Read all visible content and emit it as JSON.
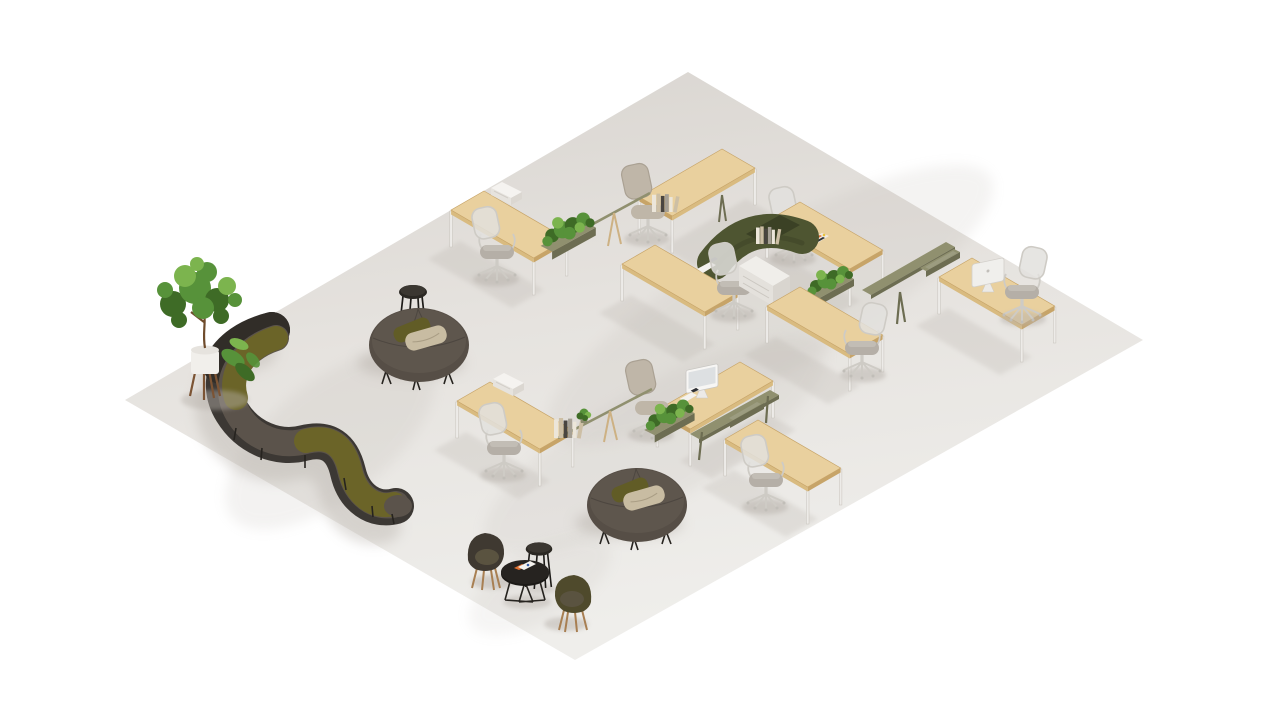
{
  "scene": {
    "description": "Isometric 3D render of an open-plan office: two zig-zag workstation pods with oak desks, task chairs, olive rails, planters and a green felt privacy screen on a light gray floor; a serpentine brown-and-olive modular sofa, two round ottomans with pillows, a potted fig tree, and a cafe corner with tub chairs and small black tables",
    "background": "#ffffff"
  },
  "palette": {
    "floor-top": "#d8d4cf",
    "floor-mid": "#e6e3df",
    "floor-bottom": "#efeeeb",
    "shadow": "#b7b1aa",
    "wood": "#e9d09e",
    "wood-edge": "#c7a468",
    "wood-shade": "#d9bb80",
    "leg": "#edebe8",
    "olive": "#90906f",
    "olive-dark": "#6d6d52",
    "felt-green": "#4e5531",
    "felt-dark": "#3b4125",
    "plant-dark": "#3e6b26",
    "plant-mid": "#57923a",
    "plant-light": "#7cb44e",
    "mesh": "#e2e0dd",
    "chair-frame": "#cecbc5",
    "chair-seat": "#b5afa7",
    "chair-cushion": "#bfb6a8",
    "sofa-back": "#3c3834",
    "sofa-charcoal": "#312d28",
    "sofa-brown": "#5b534b",
    "sofa-olive": "#6b6428",
    "ottoman": "#564e46",
    "ottoman-top": "#5e564d",
    "pillow-olive": "#615c26",
    "pillow-beige": "#c8bca2",
    "cafe-chair-dark": "#3f3931",
    "cafe-chair-olive": "#4f4a2c",
    "cafe-cushion": "#5a5340",
    "stand-brown": "#a87f52",
    "pot-white": "#f1efeb",
    "pot-stand": "#7c5434",
    "trunk": "#6f4c2c",
    "white": "#f7f6f4",
    "screen-gray": "#dde0e2",
    "paper": "#f4f2ee",
    "poster-orange": "#df7030",
    "poster-blue": "#3a5fa8",
    "book-cream": "#ece6da",
    "book-tan": "#cdbfa5",
    "book-dark": "#494540",
    "book-gray": "#a59f94"
  },
  "inventory": {
    "workstation_desks": 9,
    "task_chairs": 9,
    "desktop_monitors": 2,
    "white_desk_devices": 3,
    "desk_planters": 3,
    "small_desk_plants": 1,
    "book_sets": 3,
    "felt_privacy_screens": 1,
    "storage_pedestals": 1,
    "rail_trays": 2,
    "serpentine_sofa_segments": 6,
    "round_ottomans": 2,
    "ottoman_pillows": 4,
    "potted_trees": 1,
    "cafe_tub_chairs": 2,
    "cafe_low_tables": 1,
    "high_stool_tables": 2
  }
}
